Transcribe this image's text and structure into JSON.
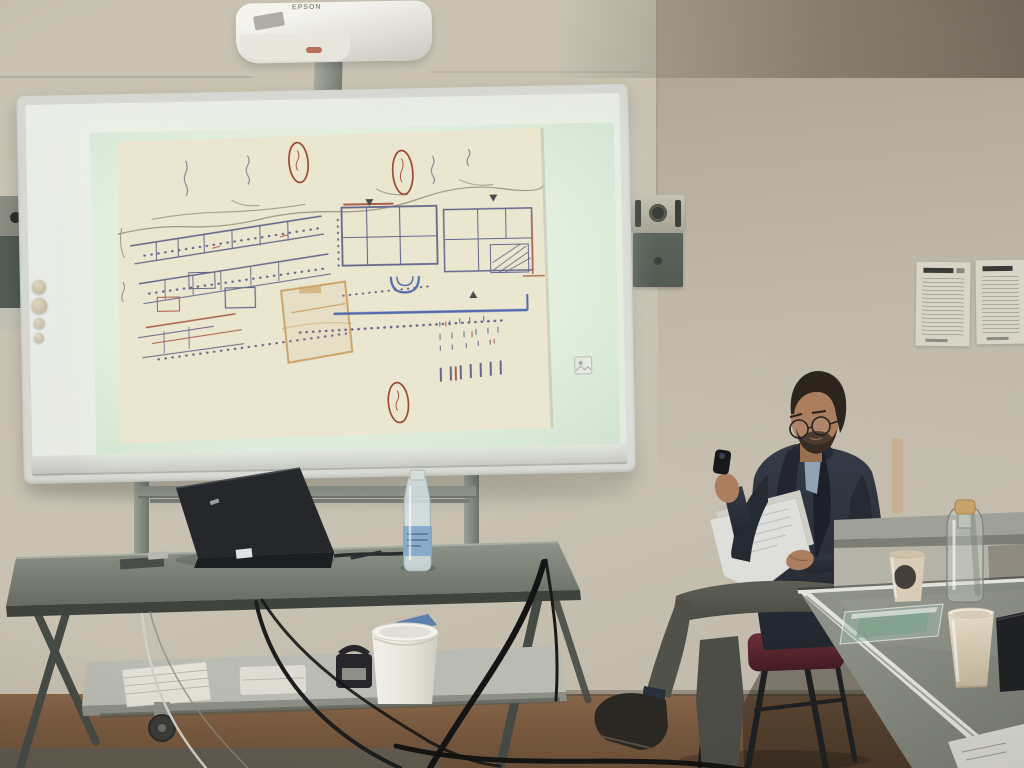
{
  "scene": {
    "kind": "photograph",
    "description": "Seminar room: a presenter sits reading notes beside a mobile whiteboard onto which an EPSON projector beams a hand-drawn archaeological excavation plan",
    "projector_brand": "EPSON"
  },
  "slide": {
    "content": "hand-drawn site plan with handwritten street labels and three red oval annotations",
    "annotation_count": 3
  },
  "colors": {
    "wall": "#c9c2b2",
    "wall-shadow": "#8e8273",
    "floor": "#7c5c41",
    "floor-dark": "#5e5a52",
    "board-frame": "#d6d7d2",
    "board-inner": "#e7eae3",
    "slide": "#e6f1e4",
    "plan-paper": "#ebe6cf",
    "plan-ink": "#50517f",
    "plan-red": "#9c4a38",
    "plan-orange": "#c59a5a",
    "plan-blue": "#3a55a8",
    "stand": "#868c82",
    "table-top": "#7c8278",
    "table-edge": "#3e433d",
    "shelf": "#babbb3",
    "laptop": "#25272a",
    "bottle-label": "#7fa6c6",
    "speaker-metal": "#b6b3a5",
    "speaker-dark": "#515b52",
    "wall-paper": "#d8d4c6",
    "skin": "#ab7e60",
    "hair": "#2c241d",
    "blazer": "#2b303a",
    "scarf": "#232630",
    "shirt": "#8fa3b5",
    "trousers": "#56584f",
    "chair-seat": "#5c2b31",
    "chair-frame": "#1e1f21",
    "cup": "#d6c9b2",
    "bucket": "#eeece4",
    "cork": "#c5a36c",
    "green-sheet": "#7fa08c",
    "sill": "#9fa198",
    "table-right": "#878b81",
    "edge-white": "#e3e4dd",
    "paper-white": "#d9d9d3"
  }
}
